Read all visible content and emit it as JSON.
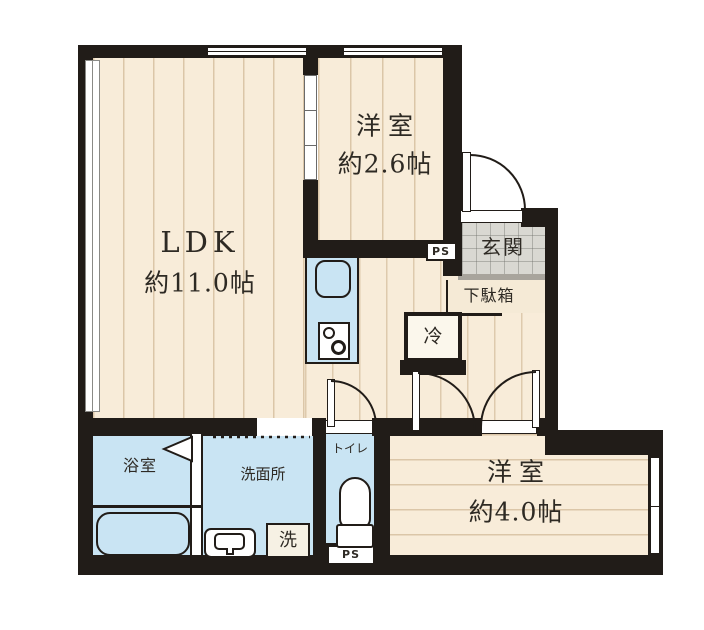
{
  "plan": {
    "type": "japanese-apartment-floor-plan",
    "rooms": {
      "ldk": {
        "name": "LDK",
        "area": "約11.0帖"
      },
      "western_room_small": {
        "name": "洋室",
        "area": "約2.6帖"
      },
      "western_room_large": {
        "name": "洋室",
        "area": "約4.0帖"
      },
      "entrance": {
        "name": "玄関"
      },
      "shoe_cabinet": {
        "name": "下駄箱"
      },
      "bathroom": {
        "name": "浴室"
      },
      "washroom": {
        "name": "洗面所"
      },
      "toilet": {
        "name": "トイレ"
      }
    },
    "fixtures": {
      "refrigerator": "冷",
      "washer": "洗",
      "pipe_space_upper": "PS",
      "pipe_space_lower": "PS"
    },
    "colors": {
      "wall": "#211c18",
      "wood_floor": "#f8ecd9",
      "wet_area": "#c9e4f3",
      "entrance_tile": "#d9d8d2",
      "background": "#ffffff"
    }
  }
}
